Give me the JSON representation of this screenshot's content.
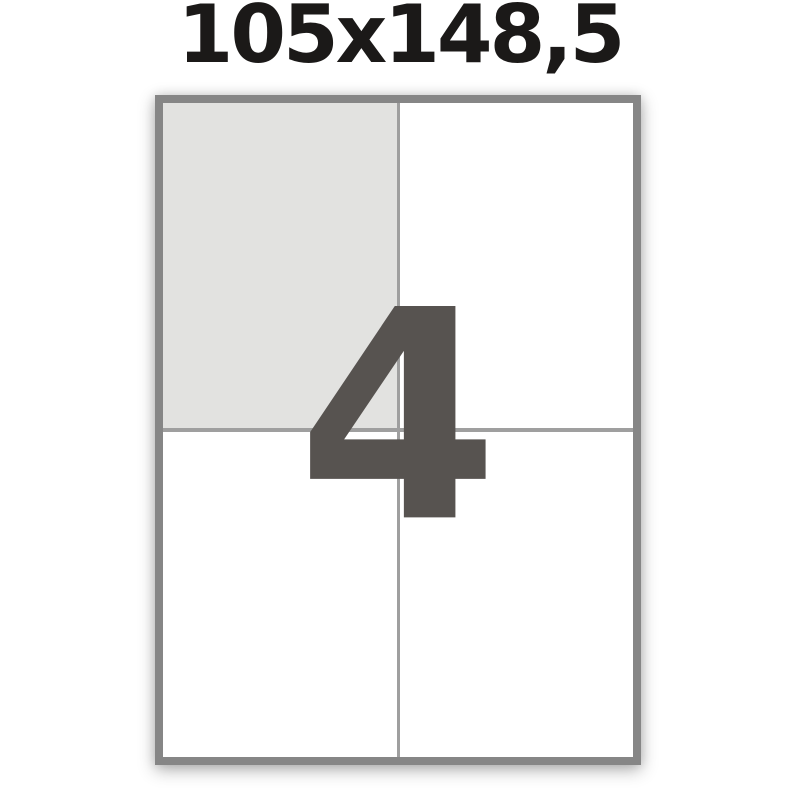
{
  "page": {
    "title": "105x148,5"
  },
  "sheet": {
    "numeral": "4",
    "rows": 2,
    "columns": 2,
    "cells": [
      {
        "position": "top-left",
        "highlighted": true
      },
      {
        "position": "top-right",
        "highlighted": false
      },
      {
        "position": "bottom-left",
        "highlighted": false
      },
      {
        "position": "bottom-right",
        "highlighted": false
      }
    ]
  },
  "colors": {
    "background": "#ffffff",
    "title_text": "#1b1918",
    "sheet_border": "#868686",
    "divider": "#9f9f9f",
    "cell_highlight": "#e2e2e0",
    "cell_default": "#ffffff",
    "numeral": "#575350"
  }
}
